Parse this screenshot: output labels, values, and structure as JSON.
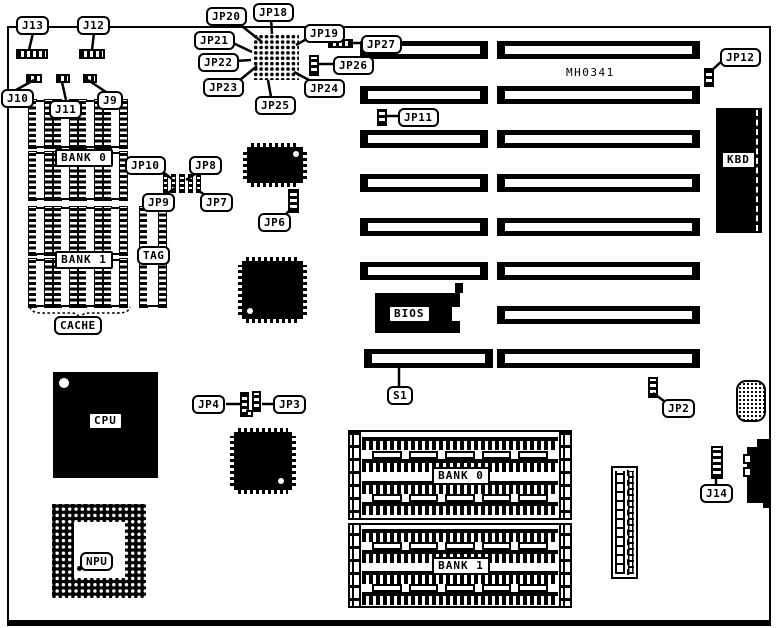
{
  "model_number": "MH0341",
  "callouts": {
    "j13": "J13",
    "j12": "J12",
    "j10": "J10",
    "j11": "J11",
    "j9": "J9",
    "jp20": "JP20",
    "jp18": "JP18",
    "jp19": "JP19",
    "jp21": "JP21",
    "jp22": "JP22",
    "jp23": "JP23",
    "jp24": "JP24",
    "jp25": "JP25",
    "jp26": "JP26",
    "jp27": "JP27",
    "jp11": "JP11",
    "jp12": "JP12",
    "jp10": "JP10",
    "jp8": "JP8",
    "jp9": "JP9",
    "jp7": "JP7",
    "jp6": "JP6",
    "jp4": "JP4",
    "jp3": "JP3",
    "jp2": "JP2",
    "j14": "J14",
    "s1": "S1"
  },
  "components": {
    "cpu": "CPU",
    "npu": "NPU",
    "bios": "BIOS",
    "kbd": "KBD",
    "tag": "TAG",
    "cache": "CACHE"
  },
  "memory": {
    "cache_bank0": "BANK 0",
    "cache_bank1": "BANK 1",
    "simm_bank0": "BANK 0",
    "simm_bank1": "BANK 1"
  },
  "colors": {
    "ink": "#000000",
    "paper": "#ffffff"
  }
}
